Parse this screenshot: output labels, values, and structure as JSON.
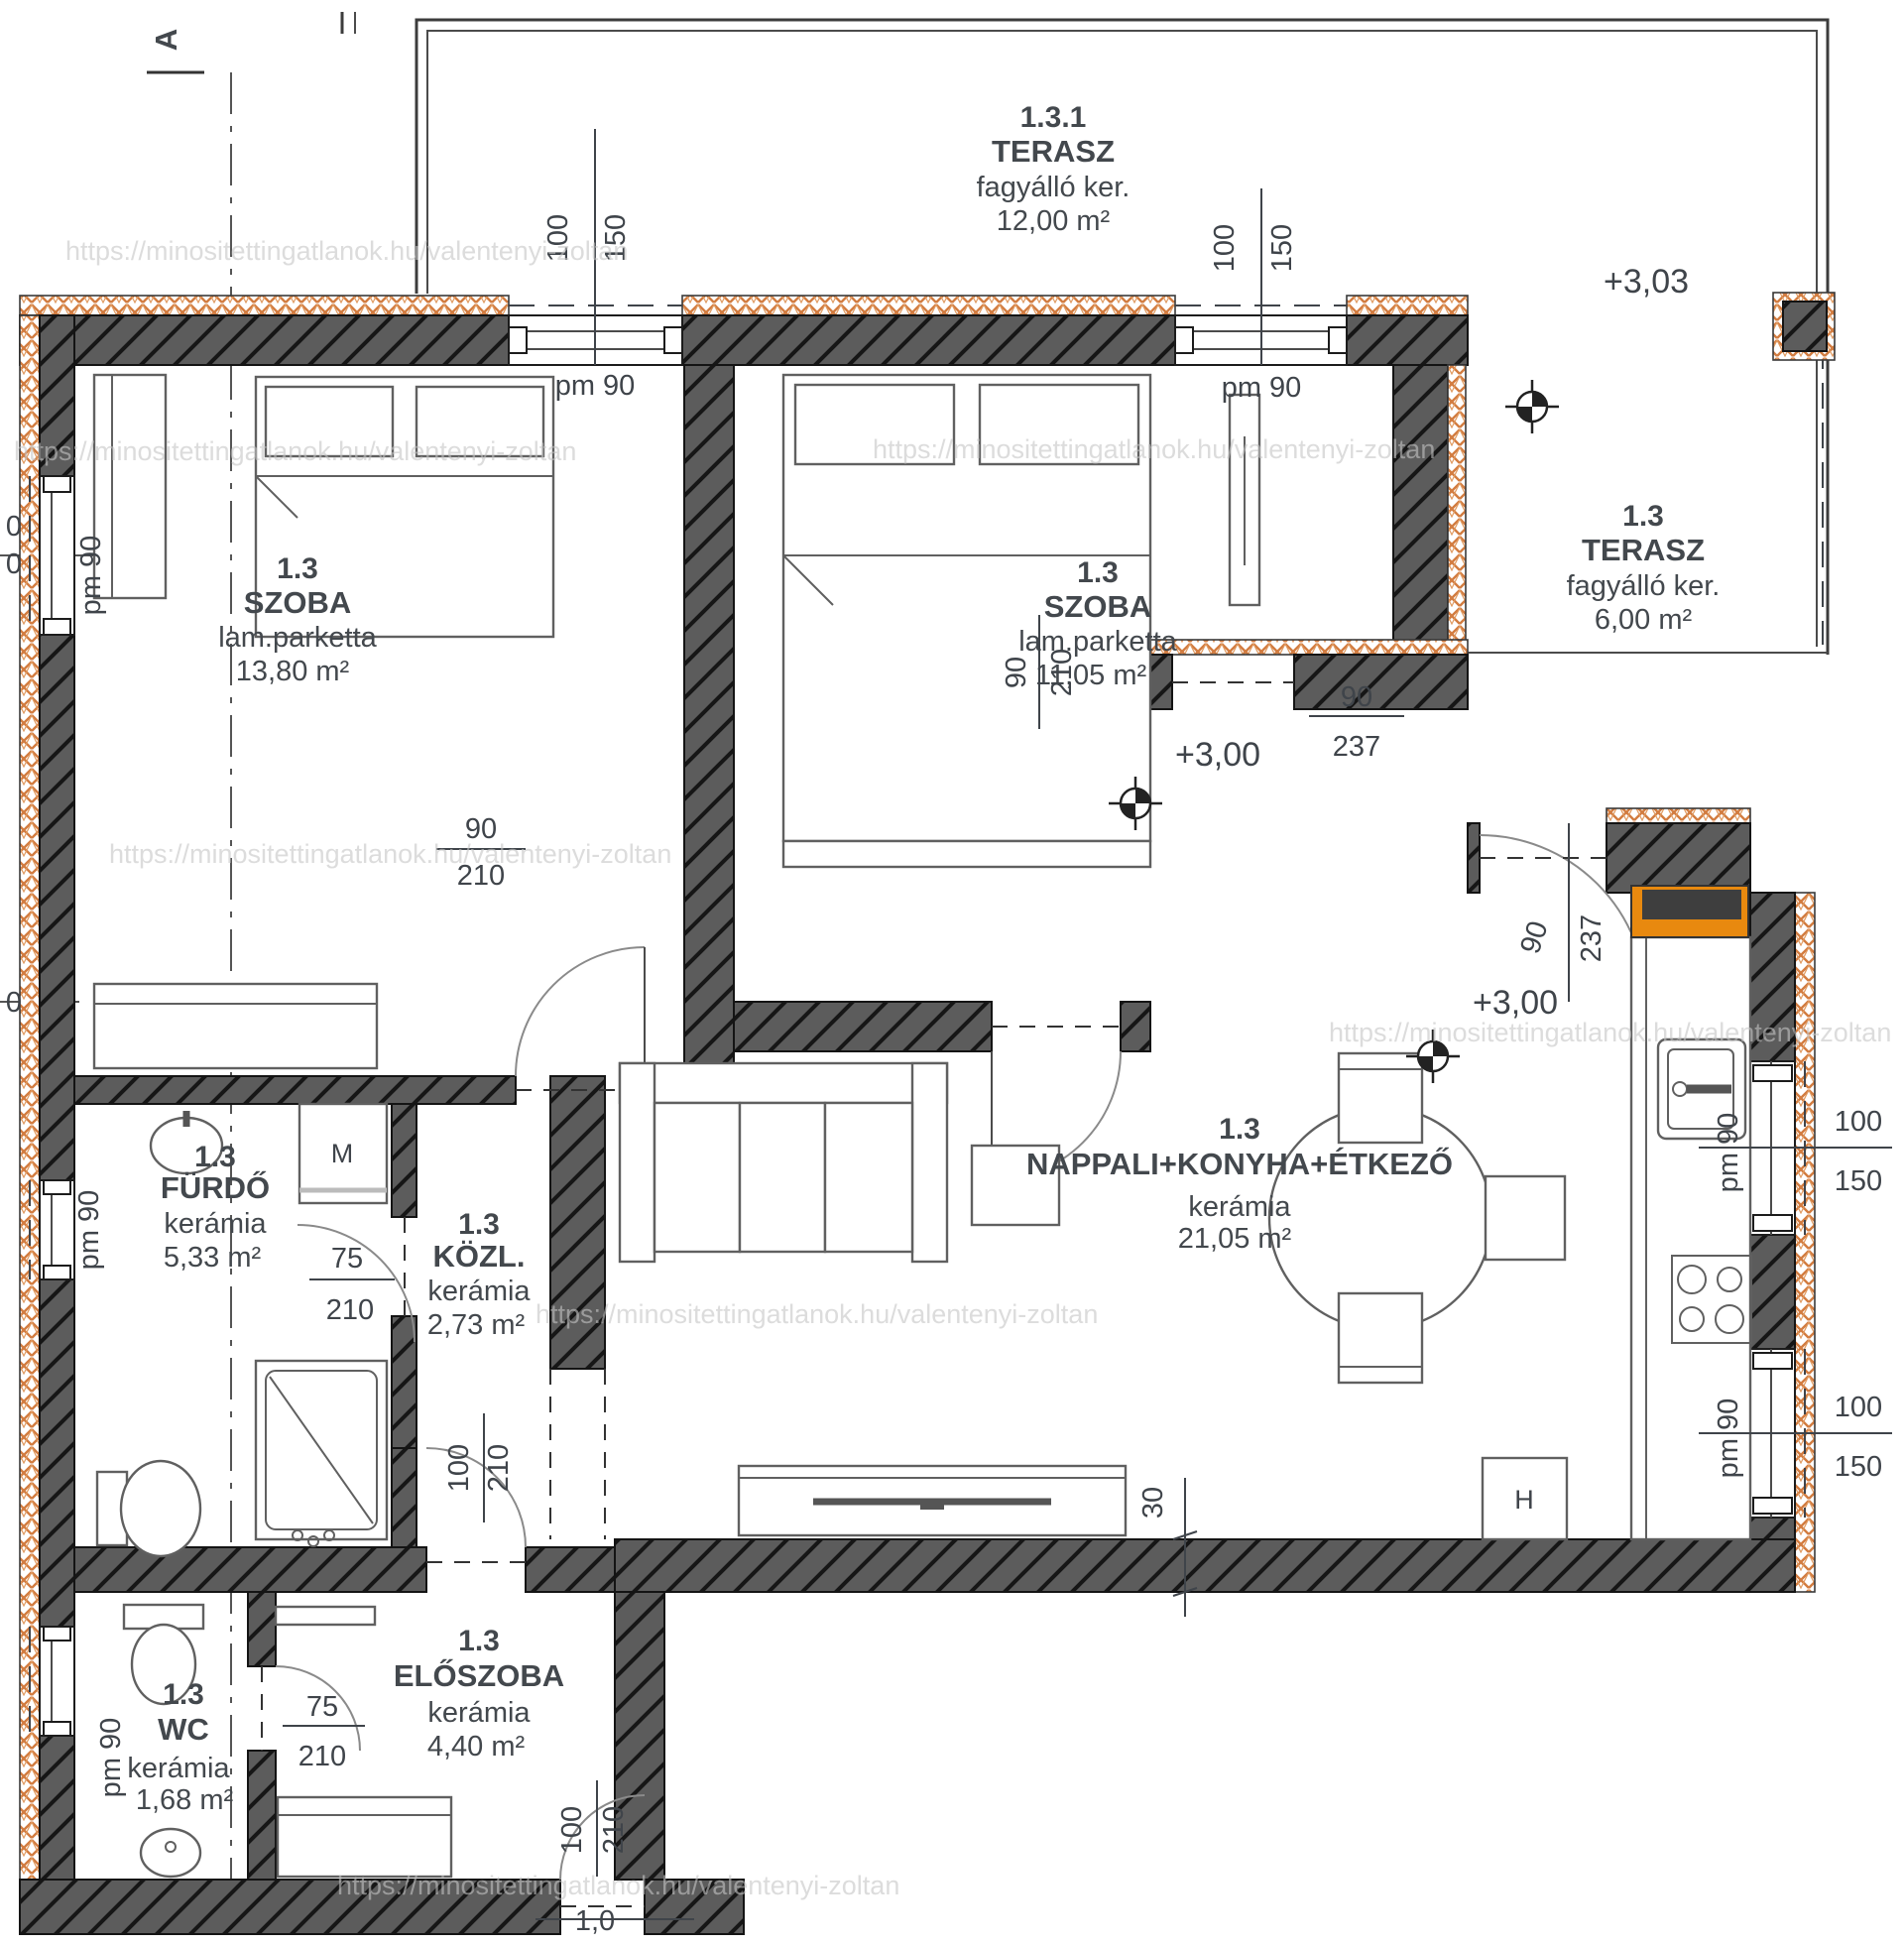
{
  "plan": {
    "section_marker": "A",
    "watermark": "https://minositettingatlanok.hu/valentenyi-zoltan",
    "rooms": [
      {
        "number": "1.3.1",
        "name": "TERASZ",
        "finish": "fagyálló ker.",
        "area": "12,00 m²"
      },
      {
        "number": "1.3",
        "name": "SZOBA",
        "finish": "lam.parketta",
        "area": "13,80 m²"
      },
      {
        "number": "1.3",
        "name": "SZOBA",
        "finish": "lam.parketta",
        "area": "11,05 m²"
      },
      {
        "number": "1.3",
        "name": "TERASZ",
        "finish": "fagyálló ker.",
        "area": "6,00 m²"
      },
      {
        "number": "1.3",
        "name": "FÜRDŐ",
        "finish": "kerámia",
        "area": "5,33 m²"
      },
      {
        "number": "1.3",
        "name": "KÖZL.",
        "finish": "kerámia",
        "area": "2,73 m²"
      },
      {
        "number": "1.3",
        "name": "NAPPALI+KONYHA+ÉTKEZŐ",
        "finish": "kerámia",
        "area": "21,05 m²"
      },
      {
        "number": "1.3",
        "name": "ELŐSZOBA",
        "finish": "kerámia",
        "area": "4,40 m²"
      },
      {
        "number": "1.3",
        "name": "WC",
        "finish": "kerámia",
        "area": "1,68 m²"
      }
    ],
    "levels": {
      "terrace": "+3,03",
      "hall": "+3,00",
      "living": "+3,00"
    },
    "dims": {
      "pm90": "pm 90",
      "w100": "100",
      "w150": "150",
      "d90": "90",
      "d210": "210",
      "d237": "237",
      "d75": "75",
      "d100": "100",
      "d30": "30",
      "d10": "1,0",
      "zero": "0"
    },
    "appliances": {
      "washing_machine": "M",
      "fridge": "H"
    }
  }
}
